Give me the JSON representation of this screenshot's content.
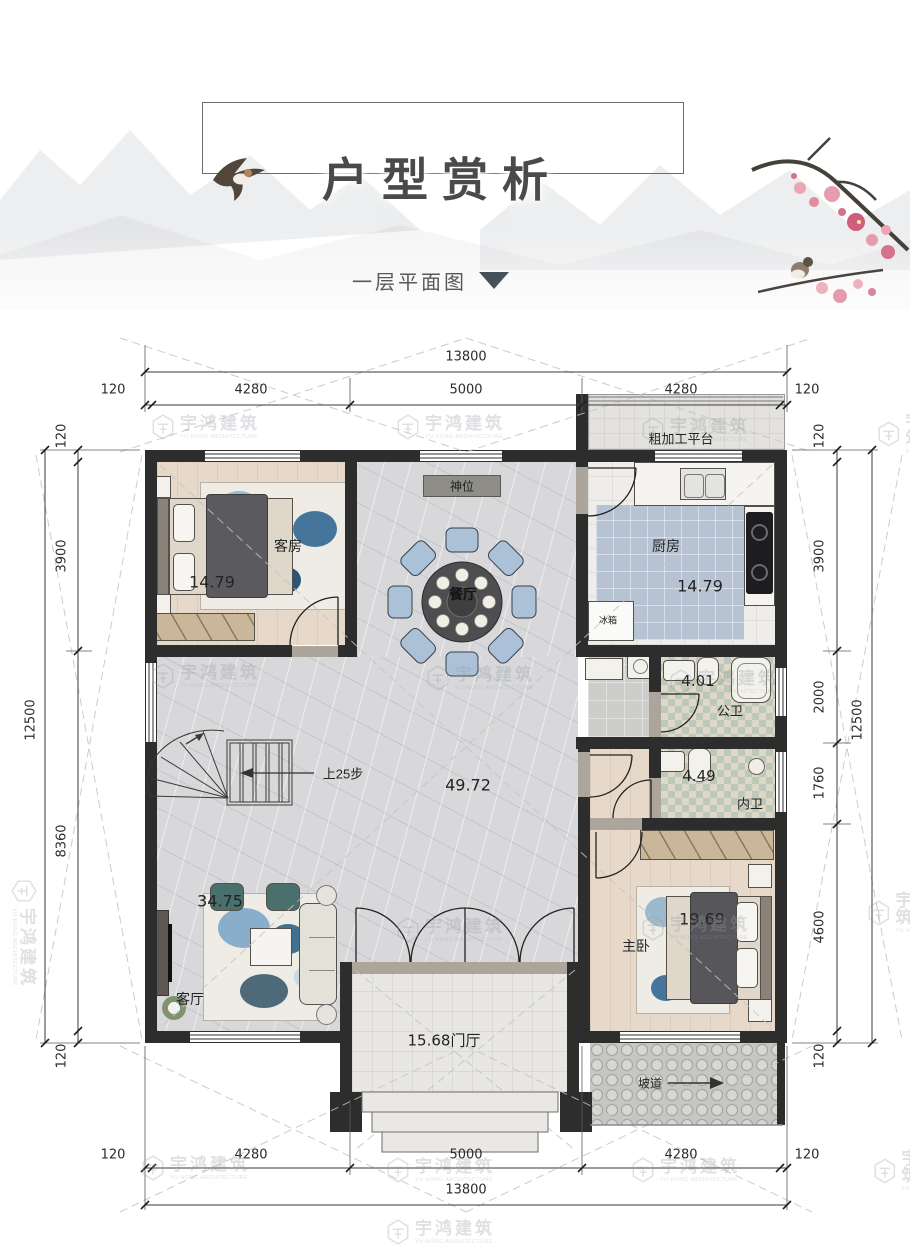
{
  "brand": {
    "cn": "宇鸿建筑",
    "en": "YU HONG ARCHITECTURE"
  },
  "header": {
    "title": "户型赏析",
    "subtitle": "一层平面图"
  },
  "plan": {
    "rooms": {
      "guest": {
        "name": "客房",
        "area": "14.79"
      },
      "dining": {
        "name": "餐厅"
      },
      "shrine": {
        "name": "神位"
      },
      "kitchen": {
        "name": "厨房",
        "area": "14.79"
      },
      "platform": {
        "name": "粗加工平台"
      },
      "fridge": {
        "name": "冰箱"
      },
      "public_bath": {
        "name": "公卫",
        "area": "4.01"
      },
      "inner_bath": {
        "name": "内卫",
        "area": "4.49"
      },
      "master": {
        "name": "主卧",
        "area": "19.69"
      },
      "living": {
        "name": "客厅",
        "area": "34.75"
      },
      "hall": {
        "area": "49.72"
      },
      "foyer": {
        "name": "门厅",
        "area": "15.68"
      },
      "stairs": {
        "label": "上25步"
      },
      "ramp": {
        "label": "坡道"
      }
    },
    "dimensions": {
      "top": {
        "total": "13800",
        "segments": [
          "120",
          "4280",
          "5000",
          "4280",
          "120"
        ]
      },
      "bottom": {
        "total": "13800",
        "segments": [
          "120",
          "4280",
          "5000",
          "4280",
          "120"
        ]
      },
      "left": {
        "total": "12500",
        "segments": [
          "120",
          "3900",
          "8360",
          "120"
        ]
      },
      "right": {
        "total": "12500",
        "segments": [
          "120",
          "3900",
          "2000",
          "1760",
          "4600",
          "120"
        ]
      }
    }
  }
}
